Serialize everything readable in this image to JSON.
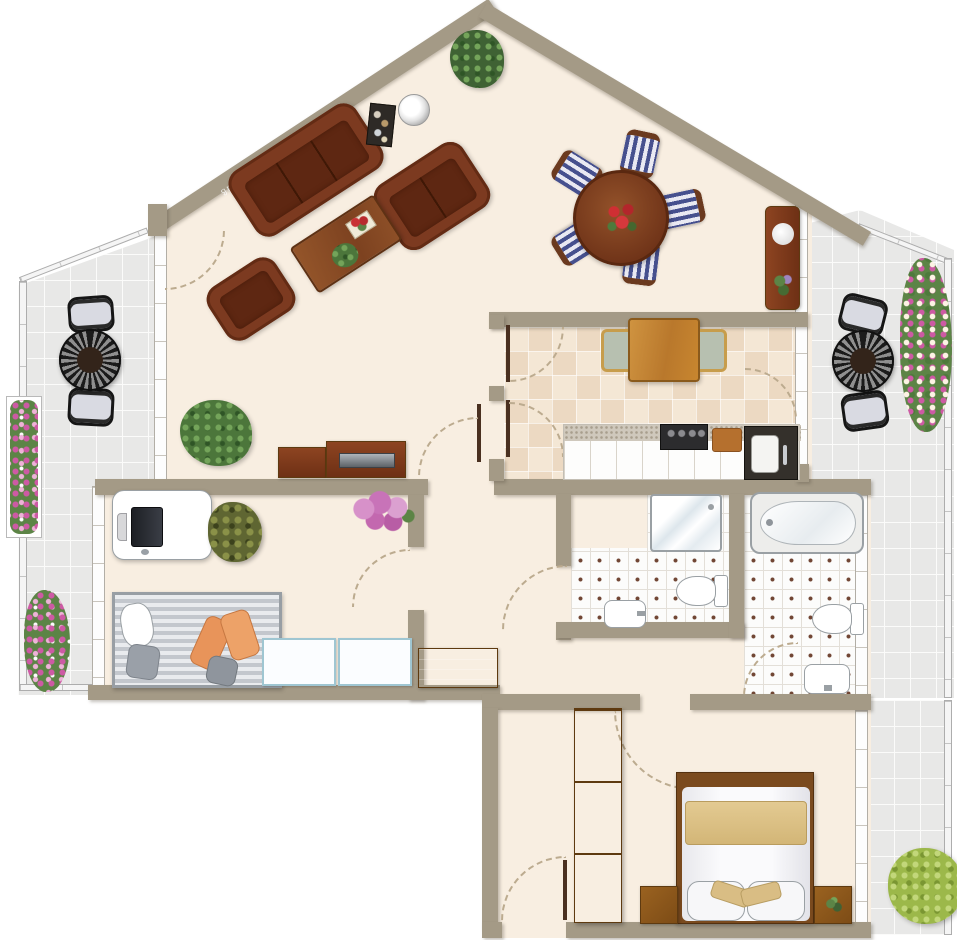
{
  "title": "apartment-floor-plan",
  "watermark": {
    "text": "ab.allegrommichnochtzlauß"
  },
  "palette": {
    "wall": "#a49a86",
    "interior_floor": "#f8eee1",
    "terrace_tile": "#e8e8e7",
    "kitchen_tile": "#f4e7d5",
    "bath_tile": "#fcfcfb",
    "sofa_leather": "#7c3a20",
    "wood_furniture": "#8a4f26",
    "wardrobe_wood": "#9a6018",
    "bed_blanket": "#ddc189",
    "dining_chair_stripe": "#46508e",
    "daybed_stripe": "#c3c7cd",
    "cushion_orange": "#e8945a",
    "plant_green": "#4c763b",
    "flower_pink": "#cd5aa4",
    "bush_green": "#9cb84a"
  }
}
